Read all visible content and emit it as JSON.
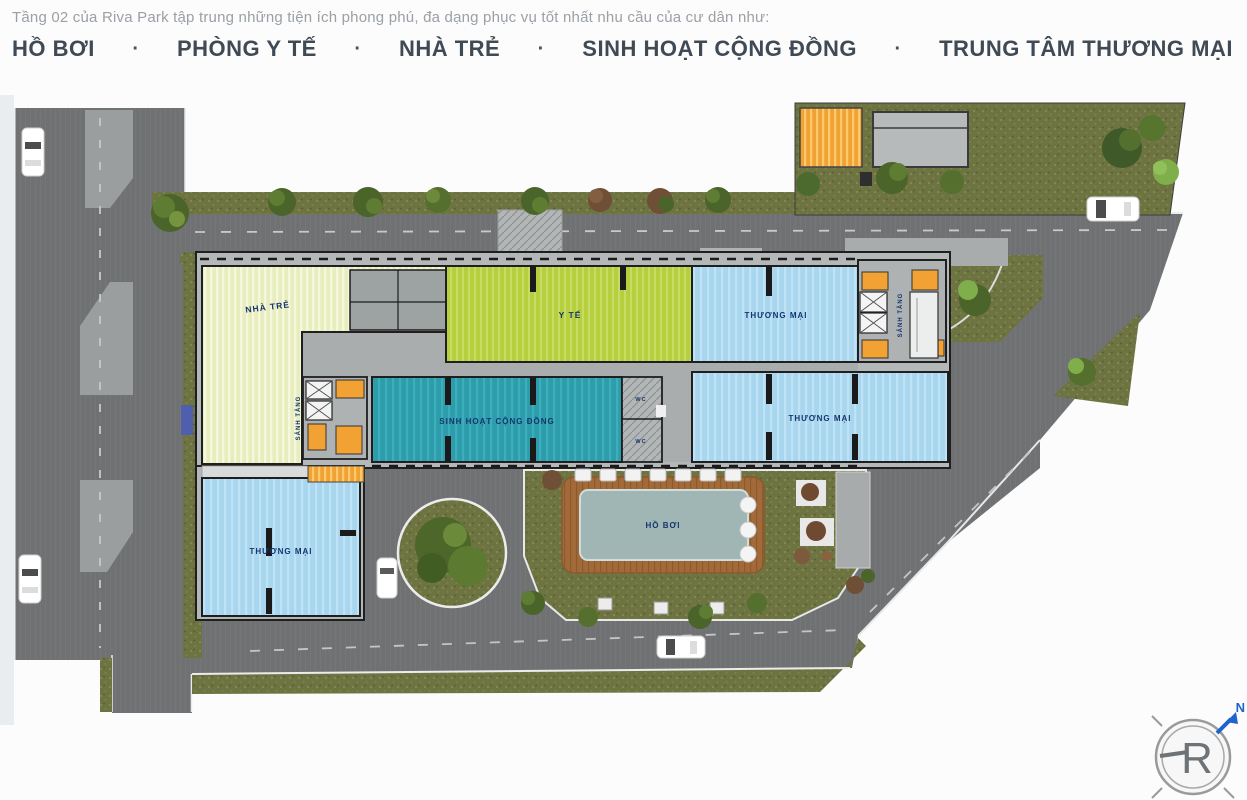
{
  "header": {
    "intro": "Tầng 02 của Riva Park tập trung những tiện ích phong phú, đa dạng phục vụ tốt nhất nhu cầu của cư dân như:",
    "separator": "·",
    "amenities": [
      "HỒ BƠI",
      "PHÒNG Y TẾ",
      "NHÀ TRẺ",
      "SINH HOẠT CỘNG ĐỒNG",
      "TRUNG TÂM THƯƠNG MẠI"
    ]
  },
  "plan": {
    "labels": {
      "nha_tre": "NHÀ TRẺ",
      "y_te": "Y TẾ",
      "thuong_mai": "THƯƠNG MẠI",
      "sinh_hoat_cong_dong": "SINH HOẠT CỘNG ĐỒNG",
      "ho_boi": "HỒ BƠI",
      "sanh_tang": "SẢNH TẦNG",
      "wc": "WC"
    },
    "compass": {
      "logo_letter": "R",
      "north_label": "N",
      "arrow_color": "#1f63cc"
    },
    "colors": {
      "nha_tre_fill": "#e7edbc",
      "y_te_fill": "#b6cf3e",
      "thuong_mai_fill": "#a9d6ef",
      "sinh_hoat_fill": "#2d9dab",
      "pool_water": "#9fb6b4",
      "pool_deck": "#a26a38",
      "elevator_orange": "#f2a232",
      "asphalt": "#6f7173",
      "grass": "#6e7342",
      "label_navy": "#16356d"
    }
  }
}
